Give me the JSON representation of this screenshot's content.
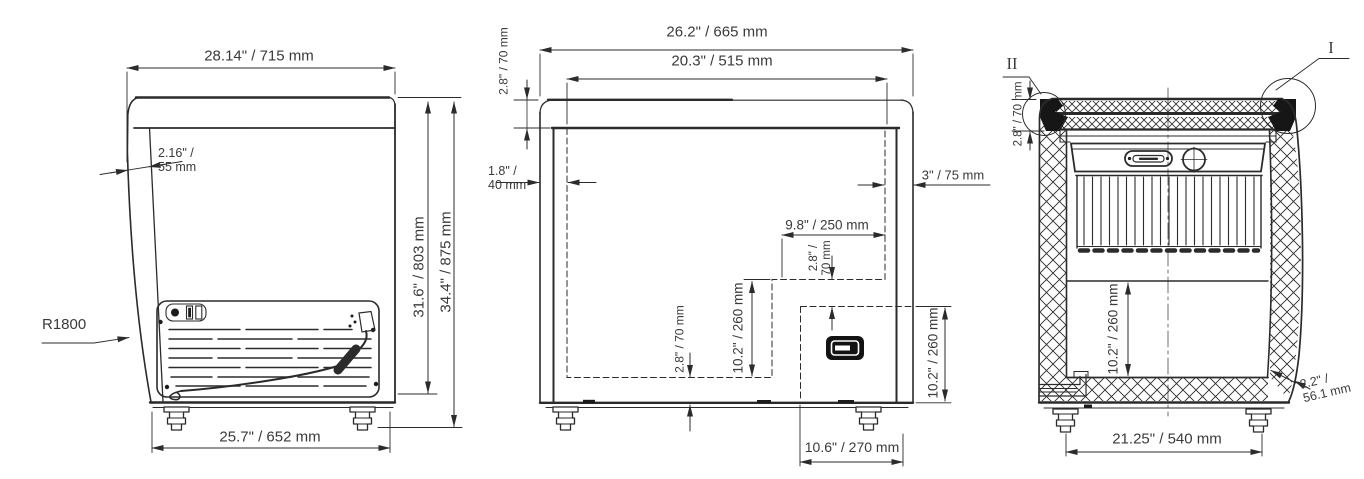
{
  "drawing_type": "chest-freezer-dimension-drawing",
  "colors": {
    "line": "#2b2b2b",
    "text": "#3a3a3a",
    "background": "#ffffff"
  },
  "views": {
    "side": {
      "labels": {
        "width_top": "28.14\" / 715 mm",
        "lid_thickness": "2.16\" /\n55 mm",
        "radius": "R1800",
        "height_body": "31.6\" / 803 mm",
        "height_total": "34.4\" / 875 mm",
        "width_bottom": "25.7\" / 652 mm"
      }
    },
    "front": {
      "labels": {
        "overall_width": "26.2\" / 665 mm",
        "opening_width": "20.3\" / 515 mm",
        "lid_height": "2.8\" / 70 mm",
        "left_inset": "1.8\" /\n40 mm",
        "right_inset": "3\" / 75 mm",
        "step_width": "9.8\" / 250 mm",
        "step_offset": "2.8\" /\n70 mm",
        "step_height": "10.2\" / 260 mm",
        "bottom_inset": "2.8\" / 70 mm",
        "compartment_height": "10.2\" / 260 mm",
        "compartment_width": "10.6\" / 270 mm"
      }
    },
    "section": {
      "labels": {
        "detail_corner": "II",
        "detail_top": "I",
        "lid_height": "2.8\" / 70 mm",
        "interior_depth": "10.2\" / 260 mm",
        "wall_thickness": "2.2\" /\n56.1 mm",
        "base_width": "21.25\" / 540 mm"
      }
    }
  }
}
